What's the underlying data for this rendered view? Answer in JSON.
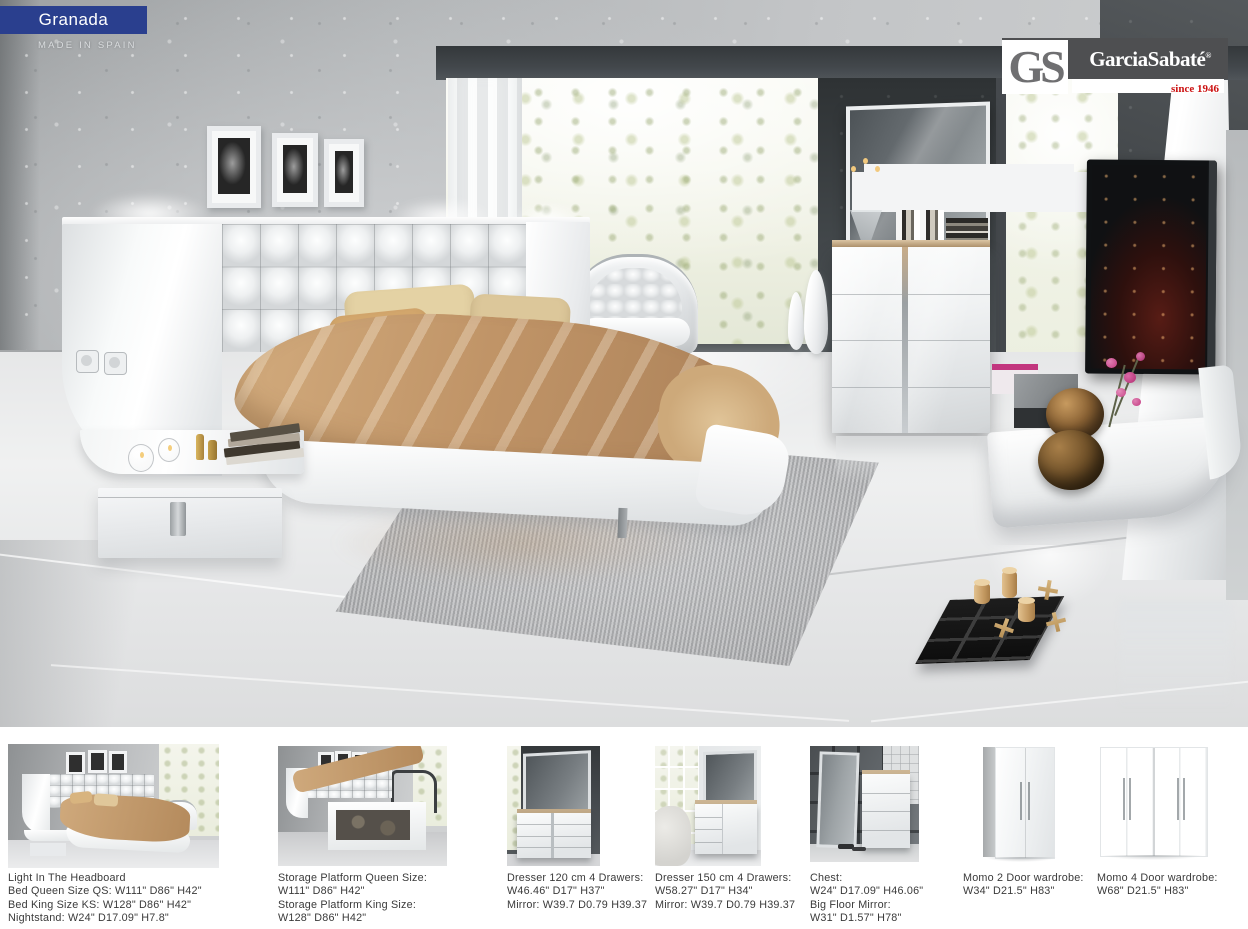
{
  "header": {
    "collection_name": "Granada",
    "made_in": "MADE IN SPAIN"
  },
  "brand": {
    "initials": "GS",
    "name": "GarciaSabaté",
    "registered_mark": "®",
    "since": "since 1946"
  },
  "colors": {
    "accent_blue": "#2a3f8e",
    "brand_red": "#cc1111"
  },
  "products": [
    {
      "id": "bed-light-headboard",
      "lines": [
        "Light In The Headboard",
        "Bed Queen Size QS: W111\" D86\" H42\"",
        "Bed King Size KS: W128\" D86\" H42\"",
        "Nightstand: W24\" D17.09\" H7.8\""
      ]
    },
    {
      "id": "storage-platform-bed",
      "lines": [
        "Storage Platform Queen Size:",
        "W111\" D86\" H42\"",
        "Storage Platform King Size:",
        "W128\" D86\" H42\""
      ]
    },
    {
      "id": "dresser-120",
      "lines": [
        "Dresser 120 cm 4 Drawers:",
        "W46.46\" D17\" H37\"",
        "Mirror: W39.7 D0.79 H39.37"
      ]
    },
    {
      "id": "dresser-150",
      "lines": [
        "Dresser 150 cm 4 Drawers:",
        "W58.27\" D17\" H34\"",
        "Mirror: W39.7 D0.79 H39.37"
      ]
    },
    {
      "id": "chest-floor-mirror",
      "lines": [
        "Chest:",
        "W24\" D17.09\" H46.06\"",
        "Big Floor Mirror:",
        "W31\" D1.57\" H78\""
      ]
    },
    {
      "id": "momo-2-door-wardrobe",
      "lines": [
        "Momo 2 Door wardrobe:",
        "W34\" D21.5\" H83\""
      ]
    },
    {
      "id": "momo-4-door-wardrobe",
      "lines": [
        "Momo 4 Door wardrobe:",
        "W68\" D21.5\" H83\""
      ]
    }
  ]
}
